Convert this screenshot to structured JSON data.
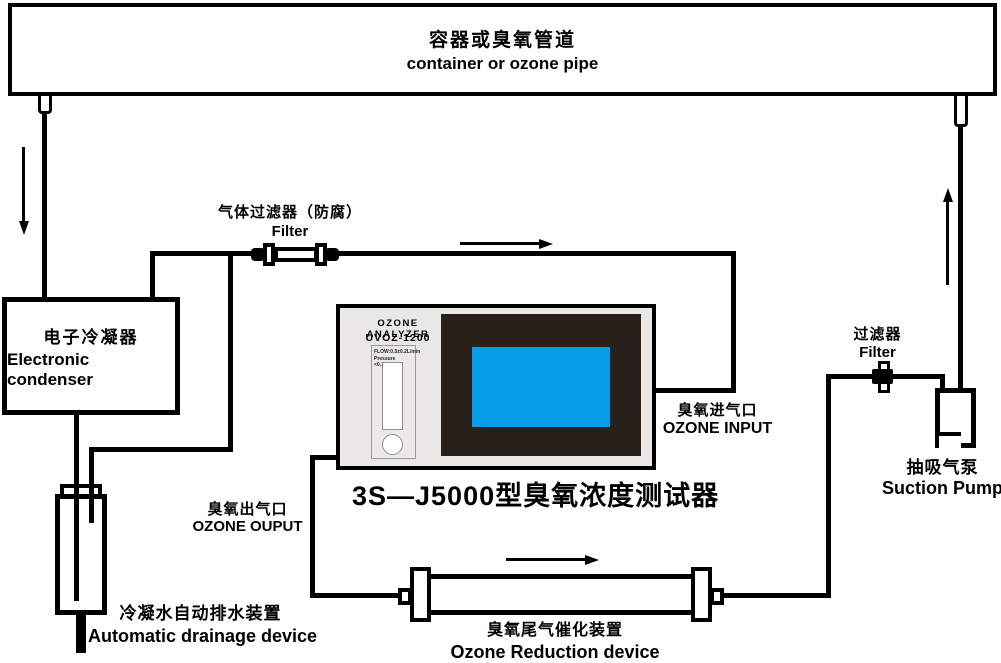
{
  "diagram_title": "3S—J5000型臭氧浓度测试器",
  "container_pipe": {
    "label_zh": "容器或臭氧管道",
    "label_en": "container or ozone pipe"
  },
  "condenser": {
    "label_zh": "电子冷凝器",
    "label_en": "Electronic condenser"
  },
  "gas_filter": {
    "label_zh": "气体过滤器（防腐）",
    "label_en": "Filter"
  },
  "analyzer": {
    "name": "OZONE  ANALYZER",
    "model": "UVOZ-1200",
    "spec_line1": "FLOW:0.5±0.2L/min",
    "spec_line2": "Pressure <0.1MPa"
  },
  "ozone_input": {
    "label_zh": "臭氧进气口",
    "label_en": "OZONE INPUT"
  },
  "ozone_output": {
    "label_zh": "臭氧出气口",
    "label_en": "OZONE OUPUT"
  },
  "drainage": {
    "label_zh": "冷凝水自动排水装置",
    "label_en": "Automatic drainage device"
  },
  "reduction": {
    "label_zh": "臭氧尾气催化装置",
    "label_en": "Ozone Reduction device"
  },
  "right_filter": {
    "label_zh": "过滤器",
    "label_en": "Filter"
  },
  "pump": {
    "label_zh": "抽吸气泵",
    "label_en": "Suction Pump"
  },
  "colors": {
    "line_black": "#000000",
    "analyzer_body": "#e9e8e5",
    "screen_bezel": "#27201b",
    "screen_blue": "#059ee9"
  }
}
